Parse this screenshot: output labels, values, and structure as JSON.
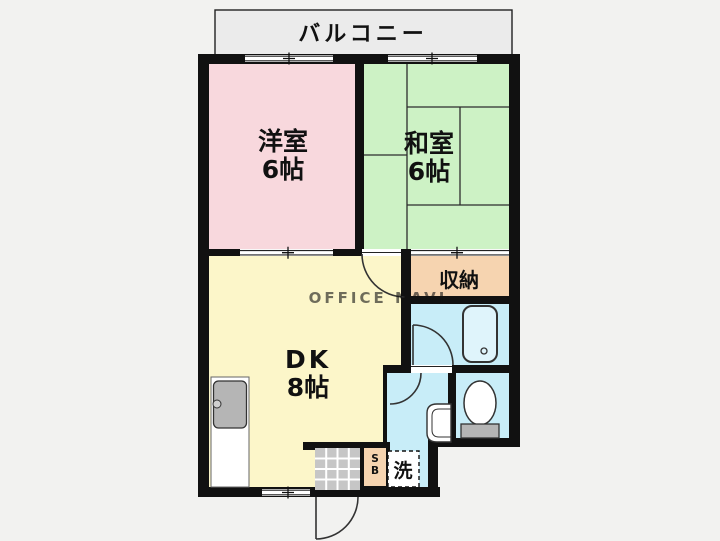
{
  "balcony": {
    "label": "バルコニー"
  },
  "rooms": {
    "western": {
      "name": "洋室",
      "size": "6帖"
    },
    "japanese": {
      "name": "和室",
      "size": "6帖"
    },
    "dk": {
      "name": "DK",
      "size": "8帖"
    },
    "storage": {
      "label": "収納"
    }
  },
  "fixtures": {
    "laundry": {
      "label": "洗"
    },
    "shoe_box": {
      "line1": "S",
      "line2": "B"
    }
  },
  "watermark": "OFFICE NAVI",
  "colors": {
    "wall": "#111111",
    "western_room": "#f8d8dd",
    "japanese_room": "#cdf2c5",
    "dk_room": "#fcf6c9",
    "storage": "#f6d4b0",
    "wet_area": "#c8edf8",
    "balcony": "#ebebeb",
    "tile": "#c6c6c6",
    "fixture_gray": "#b5b5b5",
    "bathtub_fill": "#dff4fb",
    "background": "#f2f2f0"
  }
}
